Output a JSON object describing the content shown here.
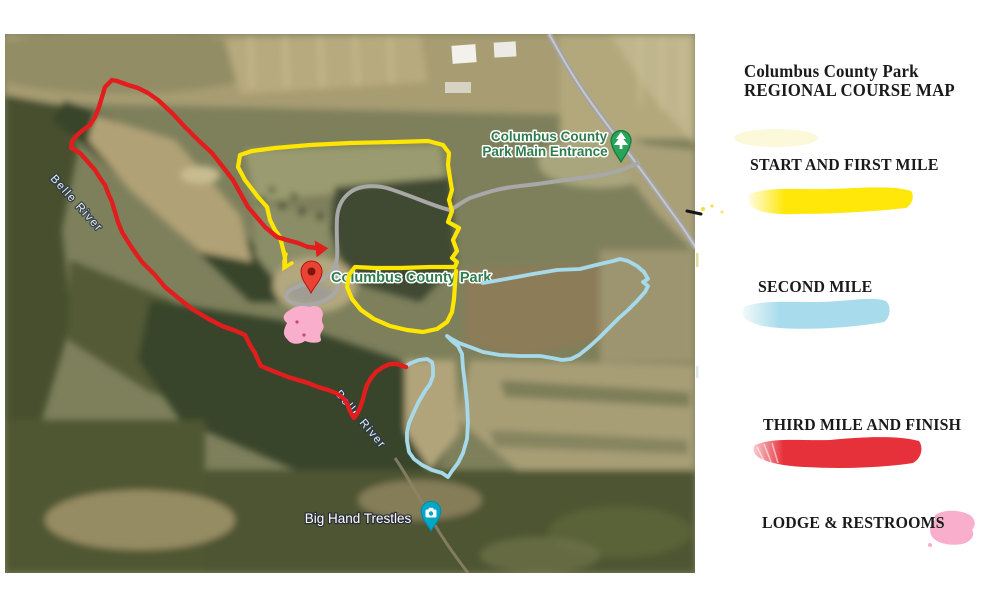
{
  "legend": {
    "title_line1": "Columbus County Park",
    "title_line2": "REGIONAL COURSE MAP",
    "items": [
      {
        "id": "first-mile",
        "label": "START AND FIRST MILE",
        "color": "#ffe70a"
      },
      {
        "id": "second-mile",
        "label": "SECOND MILE",
        "color": "#a8dcec"
      },
      {
        "id": "third-mile",
        "label": "THIRD MILE AND FINISH",
        "color": "#e6303a"
      },
      {
        "id": "lodge",
        "label": "LODGE & RESTROOMS",
        "color": "#f9afcb"
      }
    ]
  },
  "map": {
    "labels": {
      "belle_river_upper": "Belle River",
      "belle_river_lower": "Belle River",
      "entrance_line1": "Columbus County",
      "entrance_line2": "Park Main Entrance",
      "park_name": "Columbus County Park",
      "trestles": "Big Hand Trestles"
    },
    "label_colors": {
      "park_green": "#2f7d4c",
      "water": "#e6edf7",
      "poi_white": "#ffffff"
    }
  },
  "routes": {
    "first_mile_color": "#ffe600",
    "second_mile_color": "#a6d9ea",
    "third_mile_color": "#e21d1d",
    "lodge_fill": "#f9aecb"
  },
  "markers": {
    "entrance_pin_color": "#2aa45a",
    "entrance_pin_edge": "#107a3e",
    "place_pin_color": "#ea4335",
    "place_pin_dot": "#7c150c",
    "photo_pin_color": "#00a7c7"
  }
}
